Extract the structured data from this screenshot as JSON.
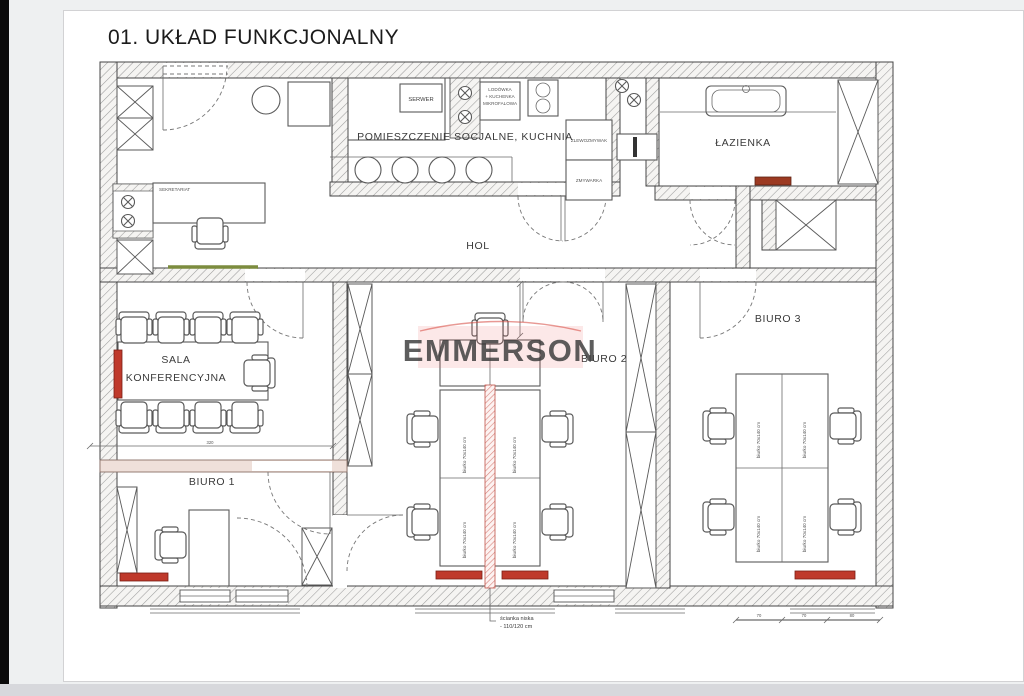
{
  "window": {
    "title": "01. UKŁAD FUNKCJONALNY"
  },
  "watermark": {
    "text": "EMMERSON"
  },
  "rooms": {
    "kitchen": "POMIESZCZENIE SOCJALNE, KUCHNIA",
    "server_room": "SERWER",
    "bathroom": "ŁAZIENKA",
    "hall": "HOL",
    "conference_line1": "SALA",
    "conference_line2": "KONFERENCYJNA",
    "office1": "BIURO 1",
    "office2": "BIURO 2",
    "office3": "BIURO 3",
    "secretariat": "SEKRETARIAT"
  },
  "fixtures": {
    "sink": "ZLEWOZMYWAK",
    "dishwasher": "ZMYWARKA",
    "fridge_line1": "LODÓWKA",
    "fridge_line2": "+ KUCHENKA",
    "fridge_line3": "MIKROFALOWA",
    "desk_size": "biurko 70x140 cm"
  },
  "annotations": {
    "low_wall_line1": "ścianka niska",
    "low_wall_line2": "- 110/120 cm",
    "conference_dim": "320",
    "dims_right": [
      "70",
      "70",
      "80"
    ]
  },
  "colors": {
    "radiator_red": "#bf392b",
    "watermark_red": "#e2423c",
    "accent_green": "#7c8c3e"
  }
}
